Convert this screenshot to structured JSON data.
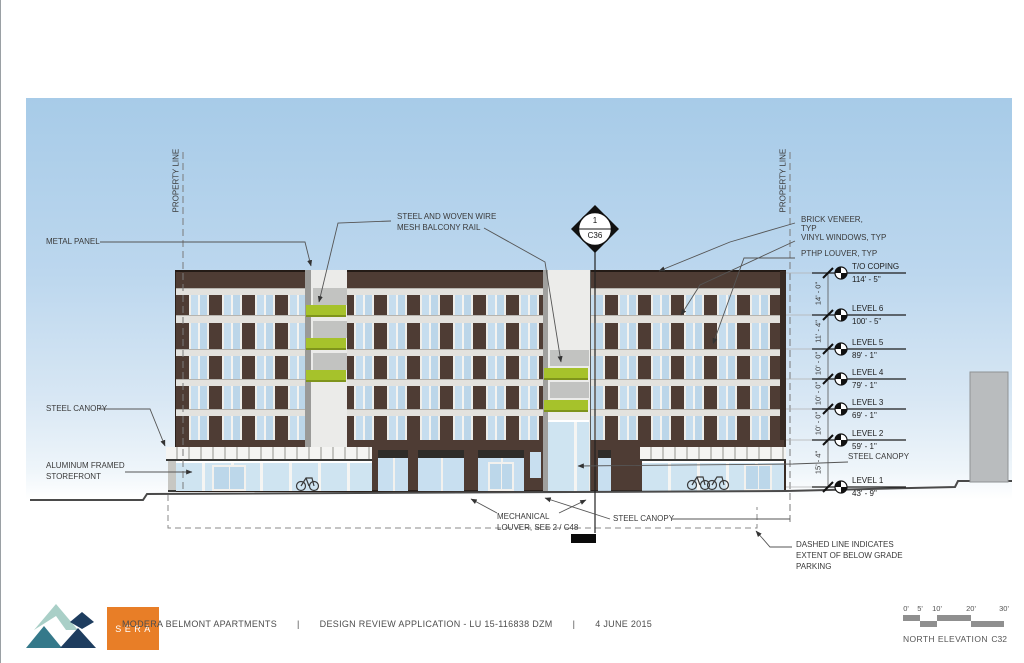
{
  "drawing": {
    "annotations": {
      "metal_panel": "METAL PANEL",
      "mesh_rail_line1": "STEEL AND WOVEN WIRE",
      "mesh_rail_line2": "MESH BALCONY RAIL",
      "steel_canopy_left": "STEEL CANOPY",
      "storefront_line1": "ALUMINUM FRAMED",
      "storefront_line2": "STOREFRONT",
      "property_line_left": "PROPERTY LINE",
      "property_line_right": "PROPERTY LINE",
      "brick_veneer_line1": "BRICK VENEER,",
      "brick_veneer_line2": "TYP",
      "vinyl_windows": "VINYL WINDOWS, TYP",
      "pthp_louver": "PTHP LOUVER, TYP",
      "mech_louver_line1": "MECHANICAL",
      "mech_louver_line2": "LOUVER, SEE 2 / C48",
      "steel_canopy_bottom": "STEEL CANOPY",
      "steel_canopy_right": "STEEL CANOPY",
      "dashed_note_line1": "DASHED LINE INDICATES",
      "dashed_note_line2": "EXTENT OF BELOW GRADE",
      "dashed_note_line3": "PARKING"
    },
    "section_marker": {
      "number": "1",
      "sheet": "C36"
    },
    "levels": [
      {
        "name": "T/O COPING",
        "elevation": "114' - 5\""
      },
      {
        "name": "LEVEL 6",
        "elevation": "100' - 5\""
      },
      {
        "name": "LEVEL 5",
        "elevation": "89' - 1\""
      },
      {
        "name": "LEVEL 4",
        "elevation": "79' - 1\""
      },
      {
        "name": "LEVEL 3",
        "elevation": "69' - 1\""
      },
      {
        "name": "LEVEL 2",
        "elevation": "59' - 1\""
      },
      {
        "name": "LEVEL 1",
        "elevation": "43' - 9\""
      }
    ],
    "dimensions": [
      "14' - 0\"",
      "11' - 4\"",
      "10' - 0\"",
      "10' - 0\"",
      "10' - 0\"",
      "15' - 4\""
    ]
  },
  "titlebar": {
    "logo_text": "SERA",
    "project": "MODERA BELMONT APARTMENTS",
    "separator": "|",
    "application": "DESIGN REVIEW APPLICATION - LU 15-116838  DZM",
    "date": "4 JUNE 2015"
  },
  "scalebar": {
    "ticks": [
      "0'",
      "5'",
      "10'",
      "20'",
      "30'"
    ],
    "view_name": "NORTH ELEVATION",
    "sheet_number": "C32"
  },
  "colors": {
    "brick": "#4e3c34",
    "accent_green": "#a6c22b",
    "sky_top": "#a7cbe8",
    "logo_orange": "#e87e27",
    "logo_teal": "#35798a",
    "logo_navy": "#1e3d5f",
    "logo_seafoam": "#a9cfc7"
  }
}
